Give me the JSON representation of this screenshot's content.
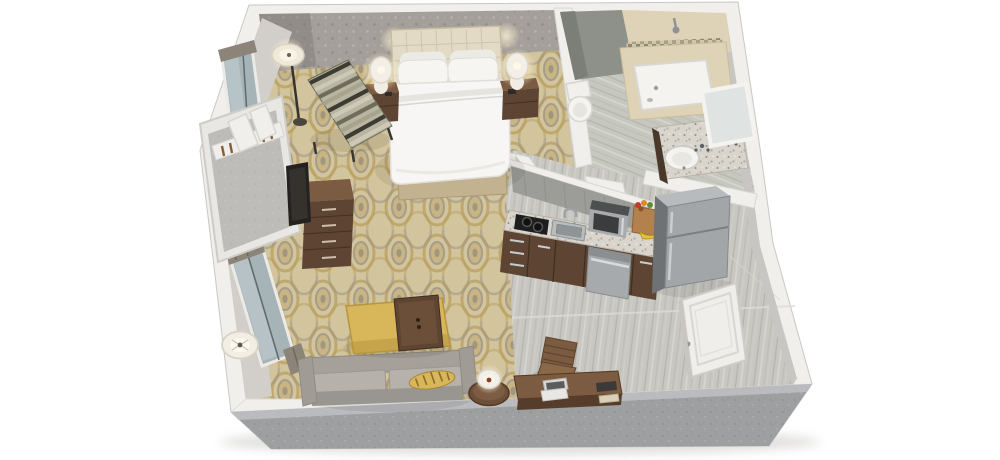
{
  "scene": {
    "title": "3D isometric floor plan of a hotel studio suite",
    "background": "#ffffff"
  },
  "palette": {
    "wall_top": "#f1efec",
    "wall_inner_face": "#d2cfca",
    "wall_right_face": "#c8c6c2",
    "wall_exterior_gray": "#9d9fa1",
    "wallpaper_base": "#a49f9a",
    "carpet_base": "#d2c49c",
    "carpet_gold": "#b89f60",
    "carpet_gray": "#9a9488",
    "tile_base": "#c8c7c1",
    "bath_tile_base": "#c6c8c0",
    "bath_wall_green": "#8e9189",
    "tub_tile": "#ded3b6",
    "granite_base": "#d9d5cc",
    "wood_dark": "#5e4533",
    "wood_mid": "#7b5b41",
    "stainless": "#a2a6a9",
    "stainless_dark": "#6e7274",
    "linen_white": "#f7f6f4",
    "headboard_cream": "#e3dac6",
    "bed_base_tan": "#c3b28f",
    "sofa_body": "#a5a19a",
    "sofa_cushion": "#b6b2ab",
    "ottoman_yellow": "#d8b65a",
    "glass_blue": "#a6b4b8",
    "curtain_gray": "#8c8379",
    "door_white": "#efeeeb",
    "cooktop_black": "#1e1e1e",
    "bag_brown": "#b3814e"
  },
  "rooms": {
    "bedroom": {
      "label": "Bedroom",
      "floor": "gold patterned carpet",
      "walls": "gray damask wallpaper",
      "items": [
        "king bed with white duvet",
        "tufted cream headboard",
        "four white pillows",
        "left nightstand",
        "right nightstand",
        "left table lamp (lit)",
        "right table lamp (lit)",
        "striped accent chair",
        "floor lamp (lit)",
        "dresser",
        "wall-mounted tv",
        "open closet with hangers",
        "window with curtains"
      ]
    },
    "bathroom": {
      "label": "Bathroom",
      "floor": "gray striped tile",
      "items": [
        "toilet",
        "bathtub",
        "beige tile tub surround",
        "mosaic accent band",
        "shower head",
        "granite vanity",
        "round white sink",
        "leaning framed mirror"
      ]
    },
    "kitchen": {
      "label": "Kitchen",
      "floor": "gray plank tile",
      "items": [
        "dark wood cabinets",
        "granite countertop",
        "two-burner cooktop",
        "stainless sink with faucet",
        "stainless microwave",
        "stainless dishwasher",
        "stainless refrigerator",
        "grocery bag with fruit",
        "bananas"
      ]
    },
    "living_area": {
      "label": "Living area",
      "items": [
        "gray sofa",
        "yellow striped bolster pillow",
        "yellow ottoman bench",
        "dark wood tray table",
        "round side table",
        "table lamp (lit)",
        "floor lamp",
        "tall window with curtains"
      ]
    },
    "entry": {
      "label": "Entry / work area",
      "items": [
        "dark wood desk",
        "brown office chair",
        "open laptop",
        "tablet",
        "notepad",
        "open entry door"
      ]
    }
  }
}
